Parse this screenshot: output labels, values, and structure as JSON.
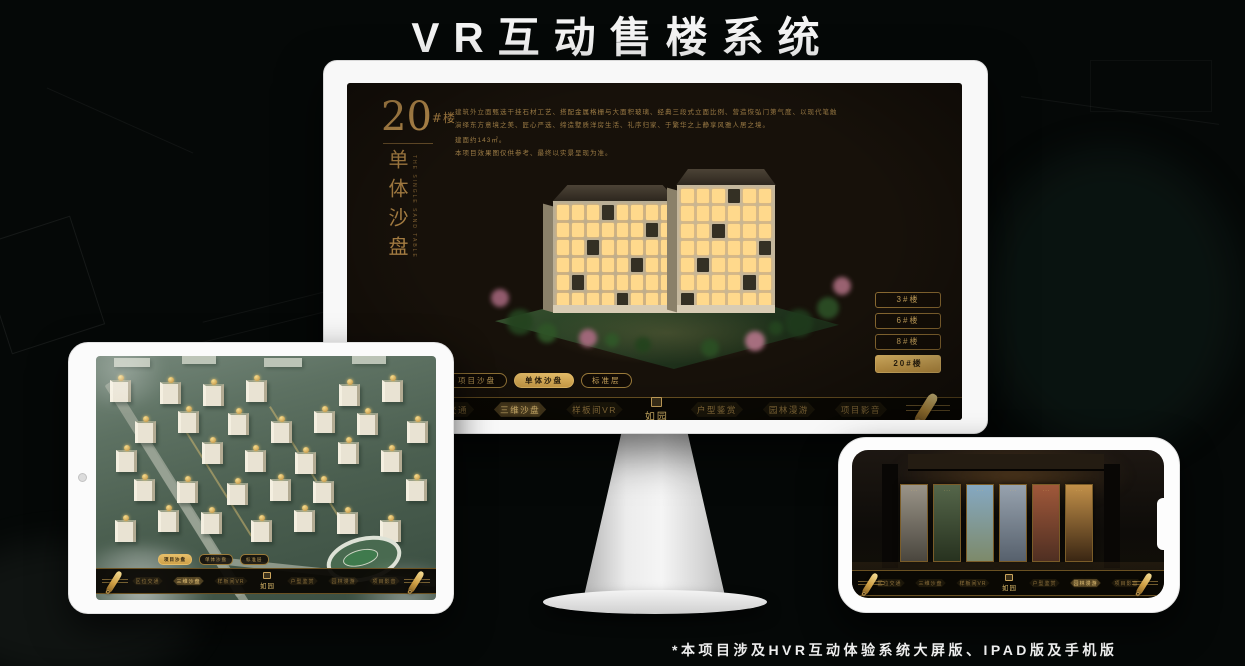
{
  "page": {
    "title": "VR互动售楼系统",
    "footnote": "*本项目涉及HVR互动体验系统大屏版、IPAD版及手机版"
  },
  "colors": {
    "gold": "#c9a45c",
    "gold_bright": "#eecf86",
    "active_fill": "#d8ab58",
    "screen_bg": "#17110a"
  },
  "brand": {
    "logo_text": "如园"
  },
  "monitor": {
    "panel": {
      "building_number": "20",
      "building_unit": "#楼",
      "vertical_title": "单体沙盘",
      "vertical_subtitle": "THE SINGLE SAND TABLE",
      "description_lines": [
        "建筑外立面甄选干挂石材工艺、搭配金属格栅与大面积玻璃、经典三段式立面比例、营造恢弘门第气度、以现代笔触",
        "演绎东方意境之美、匠心严选、缔造墅质洋房生活、礼序归家、于繁华之上静享风雅人居之境。",
        "建面约143㎡。",
        "本项目效果图仅供参考、最终以实景呈现为准。"
      ]
    },
    "floor_buttons": [
      {
        "label": "3#楼",
        "active": false
      },
      {
        "label": "6#楼",
        "active": false
      },
      {
        "label": "8#楼",
        "active": false
      },
      {
        "label": "20#楼",
        "active": true
      }
    ],
    "tabs": [
      {
        "label": "项目沙盘",
        "active": false
      },
      {
        "label": "单体沙盘",
        "active": true
      },
      {
        "label": "标准层",
        "active": false
      }
    ],
    "nav": {
      "left": [
        {
          "label": "区位交通",
          "active": false
        },
        {
          "label": "三维沙盘",
          "active": true
        },
        {
          "label": "样板间VR",
          "active": false
        }
      ],
      "right": [
        {
          "label": "户型鉴赏",
          "active": false
        },
        {
          "label": "园林漫游",
          "active": false
        },
        {
          "label": "项目影音",
          "active": false
        }
      ]
    }
  },
  "tablet": {
    "tabs": [
      {
        "label": "项目沙盘",
        "active": true
      },
      {
        "label": "单体沙盘",
        "active": false
      },
      {
        "label": "标准层",
        "active": false
      }
    ],
    "nav": {
      "left": [
        {
          "label": "区位交通",
          "active": false
        },
        {
          "label": "三维沙盘",
          "active": true
        },
        {
          "label": "样板间VR",
          "active": false
        }
      ],
      "right": [
        {
          "label": "户型鉴赏",
          "active": false
        },
        {
          "label": "园林漫游",
          "active": false
        },
        {
          "label": "项目影音",
          "active": false
        }
      ]
    }
  },
  "phone": {
    "nav": {
      "left": [
        {
          "label": "区位交通",
          "active": false
        },
        {
          "label": "三维沙盘",
          "active": false
        },
        {
          "label": "样板间VR",
          "active": false
        }
      ],
      "right": [
        {
          "label": "户型鉴赏",
          "active": false
        },
        {
          "label": "园林漫游",
          "active": true
        },
        {
          "label": "项目影音",
          "active": false
        }
      ]
    },
    "cards": [
      {
        "top": "#9a9488",
        "bottom": "#4a463e"
      },
      {
        "top": "#55664a",
        "bottom": "#27321f"
      },
      {
        "top": "#85a8c2",
        "bottom": "#7d8a6a"
      },
      {
        "top": "#97a2ae",
        "bottom": "#57616d"
      },
      {
        "top": "#a0583a",
        "bottom": "#4f2f22"
      },
      {
        "top": "#c29049",
        "bottom": "#3a2613"
      }
    ]
  }
}
